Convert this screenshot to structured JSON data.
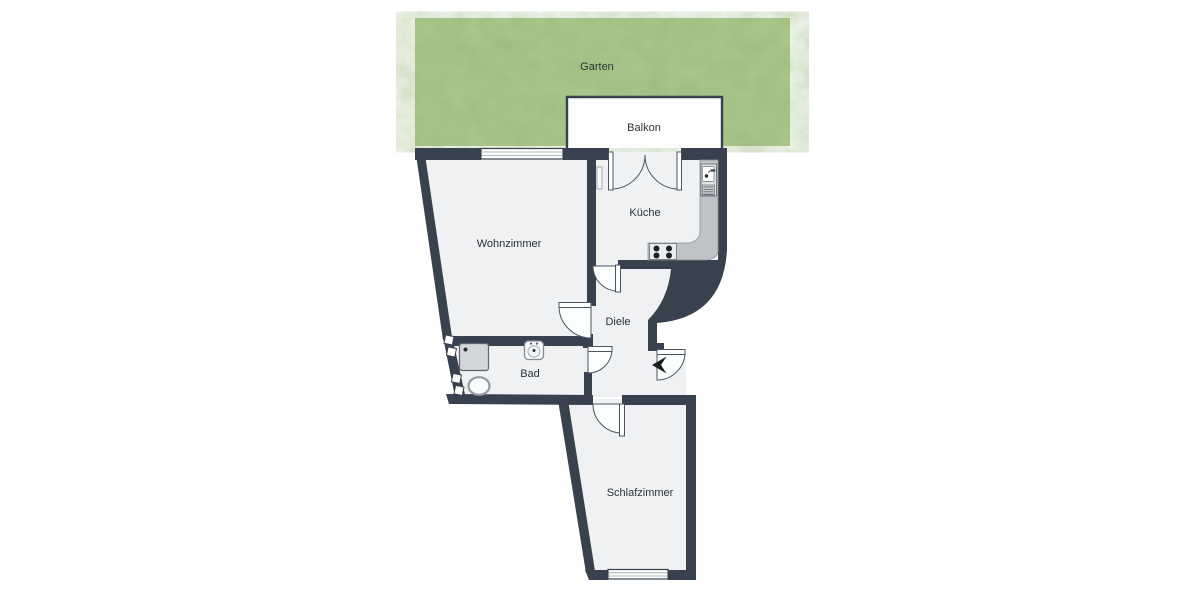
{
  "floorplan": {
    "type": "apartment-floorplan",
    "rooms": [
      {
        "id": "garten",
        "label": "Garten"
      },
      {
        "id": "balkon",
        "label": "Balkon"
      },
      {
        "id": "kueche",
        "label": "Küche"
      },
      {
        "id": "wohnzimmer",
        "label": "Wohnzimmer"
      },
      {
        "id": "diele",
        "label": "Diele"
      },
      {
        "id": "bad",
        "label": "Bad"
      },
      {
        "id": "schlafzimmer",
        "label": "Schlafzimmer"
      }
    ],
    "fixtures": [
      "kitchen-counter",
      "stove-4-burners",
      "kitchen-sink-with-drainer",
      "radiator",
      "shower-tray",
      "toilet",
      "bathroom-sink",
      "glass-block-window",
      "entrance-arrow",
      "double-balcony-door",
      "living-room-window",
      "bedroom-window"
    ],
    "doors": [
      "balcony-double-door",
      "kitchen-door",
      "living-room-door",
      "bathroom-door",
      "bedroom-door",
      "entrance-door"
    ],
    "colors": {
      "wall": "#37424e",
      "floor": "#eff1f3",
      "garden": "#aecb90",
      "garden_texture": "#7fa25c",
      "balcony": "#fdfdfd",
      "counter": "#bfc3c5",
      "door_arc_stroke": "#4b555f",
      "label_text": "#2d3238",
      "background": "#ffffff"
    }
  }
}
